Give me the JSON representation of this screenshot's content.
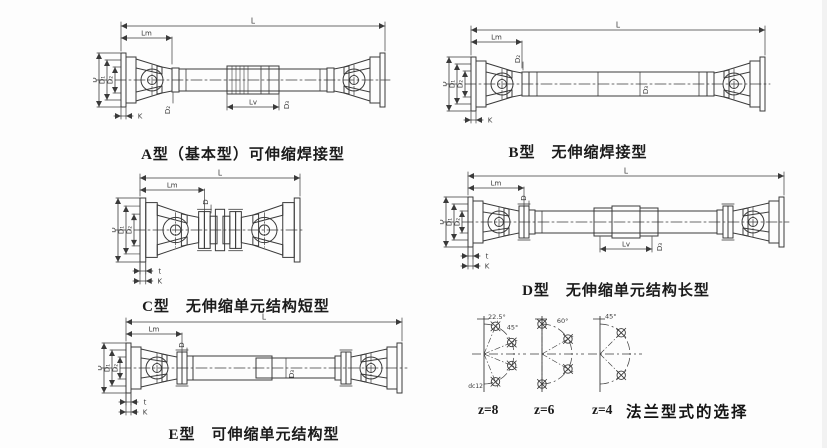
{
  "page": {
    "bg": "#fdfdfd",
    "ink": "#3a3a3a",
    "caption_color": "#1b1b1b"
  },
  "diagrams": [
    {
      "id": "A",
      "caption": "A型（基本型）可伸缩焊接型",
      "dims": {
        "top": "L",
        "top_left": "Lm",
        "left": [
          "D",
          "D₁",
          "D₂"
        ],
        "bottom_left": [
          "K"
        ],
        "collar": "D₂",
        "mid_len": "Lv",
        "mid_dia": "D₃"
      }
    },
    {
      "id": "B",
      "caption": "B型　无伸缩焊接型",
      "dims": {
        "top": "L",
        "top_left": "Lm",
        "left": [
          "D",
          "D₁",
          "D₂"
        ],
        "bottom_left": [
          "K"
        ],
        "collar": "D₂",
        "tube_dia": "D₃"
      }
    },
    {
      "id": "C",
      "caption": "C型　无伸缩单元结构短型",
      "dims": {
        "top": "L",
        "top_left": "Lm",
        "left": [
          "D",
          "D₁",
          "D₂"
        ],
        "bottom_left": [
          "t",
          "K"
        ],
        "collar": "D"
      }
    },
    {
      "id": "D",
      "caption": "D型　无伸缩单元结构长型",
      "dims": {
        "top": "L",
        "top_left": "Lm",
        "left": [
          "D",
          "D₁",
          "D₂"
        ],
        "bottom_left": [
          "t",
          "K"
        ],
        "collar": "D",
        "mid_len": "Lv",
        "mid_dia": "D₃"
      }
    },
    {
      "id": "E",
      "caption": "E型　可伸缩单元结构型",
      "dims": {
        "top": "L",
        "top_left": "Lm",
        "left": [
          "D",
          "D₁",
          "D₂"
        ],
        "bottom_left": [
          "t",
          "K"
        ],
        "collar": "D",
        "tube_dia": "D₃"
      }
    }
  ],
  "flange_panel": {
    "caption": "法兰型式的选择",
    "variants": [
      {
        "label": "z=8",
        "angle_labels": [
          "22.5°",
          "45°"
        ],
        "note": "dc12"
      },
      {
        "label": "z=6",
        "angle_labels": [
          "60°"
        ]
      },
      {
        "label": "z=4",
        "angle_labels": [
          "45°"
        ]
      }
    ]
  }
}
